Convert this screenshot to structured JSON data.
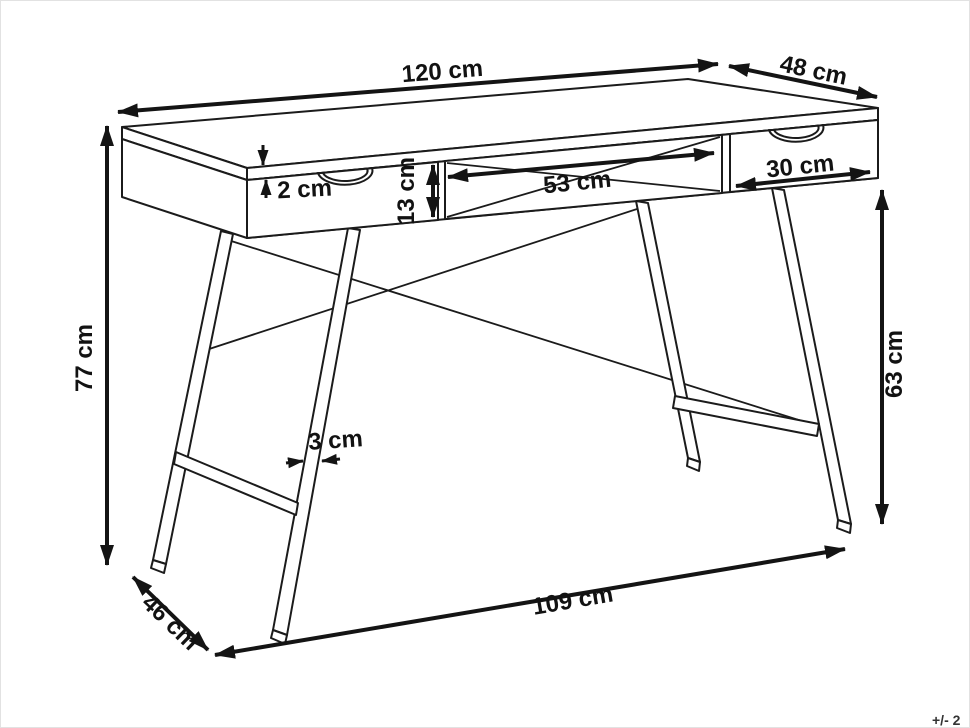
{
  "diagram": {
    "subject": "desk-with-two-drawers-and-open-niche-dimension-drawing",
    "line_color": "#1b1b1b",
    "background_color": "#ffffff",
    "dims": {
      "top_width": "120 cm",
      "top_depth": "48 cm",
      "top_thickness": "2 cm",
      "niche_height": "13 cm",
      "niche_width": "53 cm",
      "drawer_width": "30 cm",
      "overall_height": "77 cm",
      "leg_height": "63 cm",
      "leg_thickness": "3 cm",
      "base_depth": "46 cm",
      "base_width": "109 cm"
    },
    "footnote": "+/- 2"
  }
}
